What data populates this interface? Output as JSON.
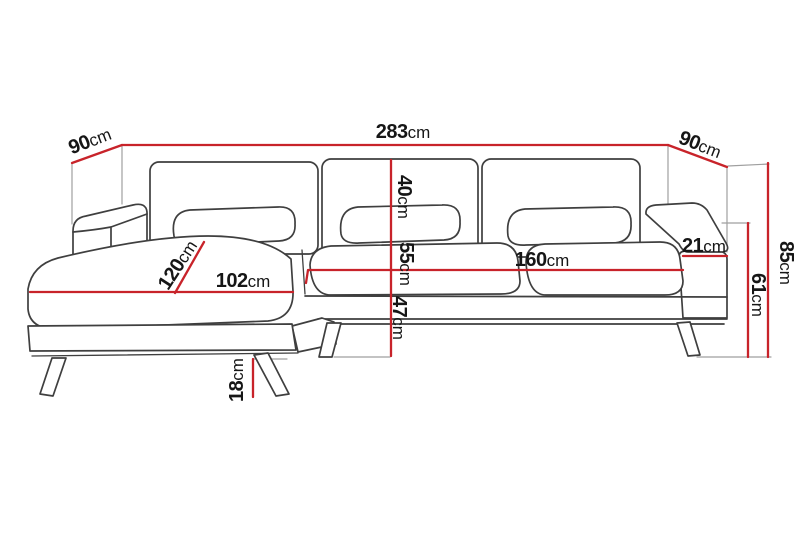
{
  "diagram": {
    "type": "dimension-diagram",
    "subject": "corner sofa with left chaise"
  },
  "colors": {
    "dimension_line": "#c8232a",
    "outline": "#3f3f3f",
    "guide": "#9f9f9f",
    "background": "#ffffff",
    "label_text": "#161616"
  },
  "dimensions": {
    "total_width": {
      "value": "283",
      "unit": "cm"
    },
    "depth_left": {
      "value": "90",
      "unit": "cm"
    },
    "depth_right": {
      "value": "90",
      "unit": "cm"
    },
    "overall_height": {
      "value": "85",
      "unit": "cm"
    },
    "armrest_height": {
      "value": "61",
      "unit": "cm"
    },
    "armrest_width": {
      "value": "21",
      "unit": "cm"
    },
    "seat_width": {
      "value": "160",
      "unit": "cm"
    },
    "backrest_height": {
      "value": "40",
      "unit": "cm"
    },
    "seat_cushion_height": {
      "value": "55",
      "unit": "cm"
    },
    "seat_frame_height": {
      "value": "47",
      "unit": "cm"
    },
    "chaise_width": {
      "value": "102",
      "unit": "cm"
    },
    "chaise_depth": {
      "value": "120",
      "unit": "cm"
    },
    "leg_height": {
      "value": "18",
      "unit": "cm"
    }
  }
}
